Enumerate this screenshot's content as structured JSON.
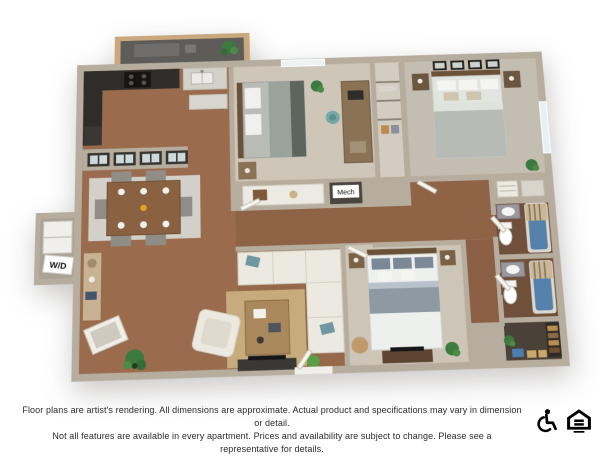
{
  "floor_plan": {
    "labels": {
      "washer_dryer": "W/D",
      "mechanical": "Mech"
    },
    "rooms": [
      "balcony",
      "kitchen",
      "dining-area",
      "living-room",
      "bedroom-2",
      "master-bedroom",
      "bedroom-3",
      "bathroom-1",
      "bathroom-2",
      "walk-in-closet",
      "washer-dryer-closet",
      "mechanical-closet",
      "hallway"
    ]
  },
  "palette": {
    "wall": "#b7ad9e",
    "wall_light": "#ddd8cd",
    "wood_floor": "#9a6c4d",
    "bath_floor": "#70503a",
    "carpet": "#cdc6b9",
    "carpet_master": "#c4bdb1",
    "balcony_floor": "#5d5c59",
    "kitchen_counter_dark": "#2f2d2a",
    "tub_blue": "#5581ab",
    "rug_tan": "#c8ab7c",
    "sofa_white": "#ece9e0",
    "plant_green": "#3e7a3f"
  },
  "footer": {
    "disclaimer_line1": "Floor plans are artist's rendering. All dimensions are approximate. Actual product and specifications may vary in dimension or detail.",
    "disclaimer_line2": "Not all features are available in every apartment. Prices and availability are subject to change. Please see a representative for details.",
    "icons": [
      "accessibility-icon",
      "equal-housing-icon"
    ]
  }
}
